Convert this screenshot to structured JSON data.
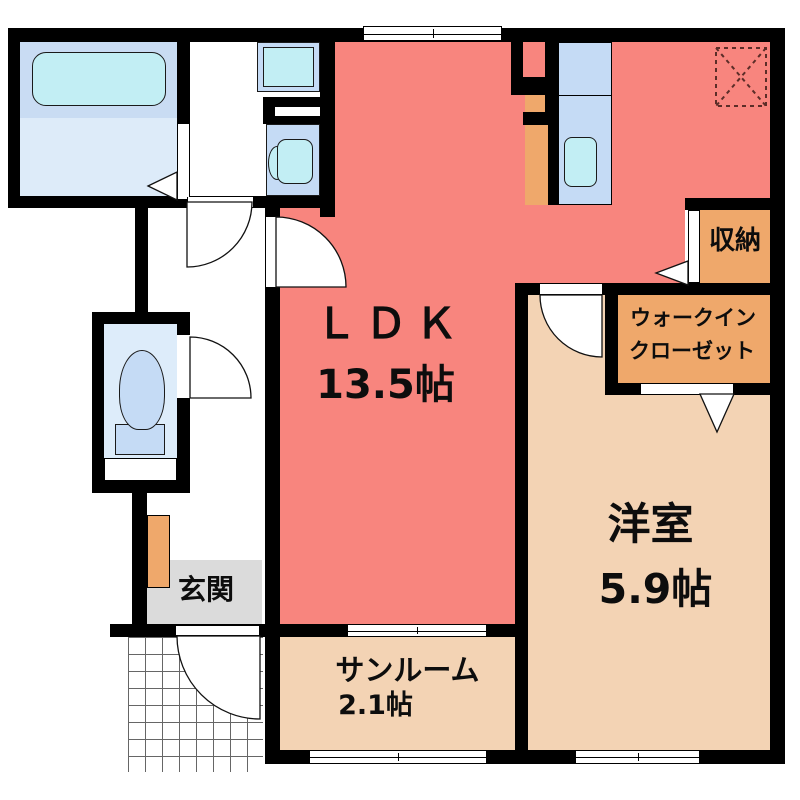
{
  "plan": {
    "title": "apartment-floor-plan",
    "rooms": {
      "ldk": {
        "name": "ＬＤＫ",
        "size": "13.5帖"
      },
      "western_room": {
        "name": "洋室",
        "size": "5.9帖"
      },
      "sunroom": {
        "name": "サンルーム",
        "size": "2.1帖"
      },
      "entrance": {
        "name": "玄関"
      },
      "storage": {
        "name": "収納"
      },
      "walk_in_closet": {
        "line1": "ウォークイン",
        "line2": "クローゼット"
      }
    },
    "colors": {
      "ldk_floor": "#f8857e",
      "tatami_rooms": "#f3d3b4",
      "closet_orange": "#efa86b",
      "entrance_gray": "#dbdbdb",
      "bath_floor": "#c9dcf3",
      "fixture_blue": "#c5dbf5",
      "fixture_cyan": "#c2eef4",
      "walls": "#000000",
      "fridge_dash": "#5c2d28"
    }
  }
}
